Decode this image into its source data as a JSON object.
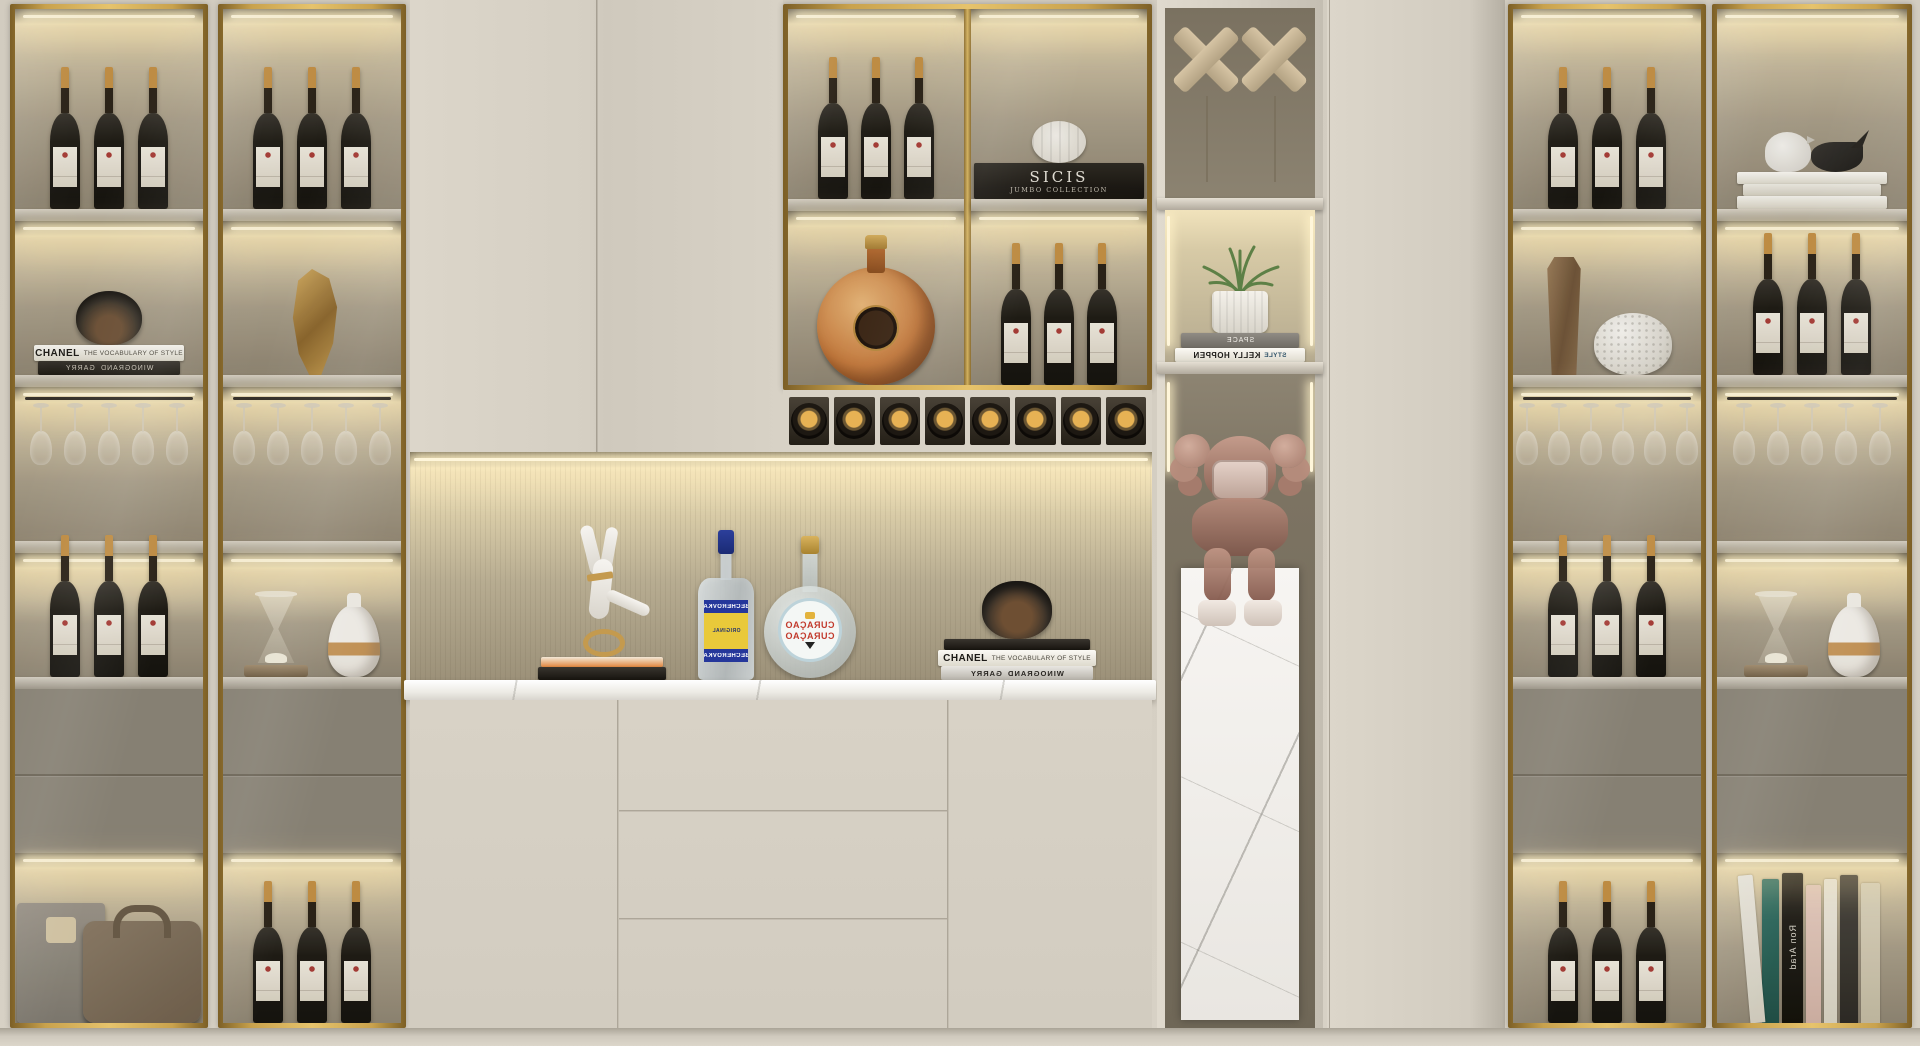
{
  "palette": {
    "gold_frame": "#c9a24d",
    "cream_door": "#d7d1c5",
    "cabinet_interior": "#8d8371",
    "led_glow": "#fff6da",
    "drawer_gray": "#8b8478",
    "alcove_beige": "#b7ac91",
    "marble_white": "#f3f1ed",
    "wine_bottle": "#1d1a14",
    "foil_gold": "#c59044",
    "label_red": "#a93c36",
    "becherovka_blue": "#25379b",
    "becherovka_yellow": "#e9c93a",
    "curacao_red": "#c23a2c",
    "plant_green": "#5d8046",
    "kaws_rose": "#c39486",
    "floor": "#d2ccc0"
  },
  "books": {
    "chanel": {
      "title": "CHANEL",
      "subtitle": "THE VOCABULARY OF STYLE"
    },
    "garry": {
      "line1": "GARRY",
      "line2": "WINOGRAND"
    },
    "sicis": {
      "title": "SICIS",
      "subtitle": "JUMBO COLLECTION"
    },
    "space": {
      "title": "SPACE"
    },
    "kelly": {
      "title": "KELLY HOPPEN",
      "accent": "STYLE"
    },
    "ron_arad": {
      "title": "Ron Arad"
    }
  },
  "liquor": {
    "becherovka": {
      "brand": "BECHEROVKA",
      "variant": "ORIGINAL"
    },
    "curacao": {
      "line1": "CURAÇAO",
      "line2": "CURAÇAO"
    }
  }
}
